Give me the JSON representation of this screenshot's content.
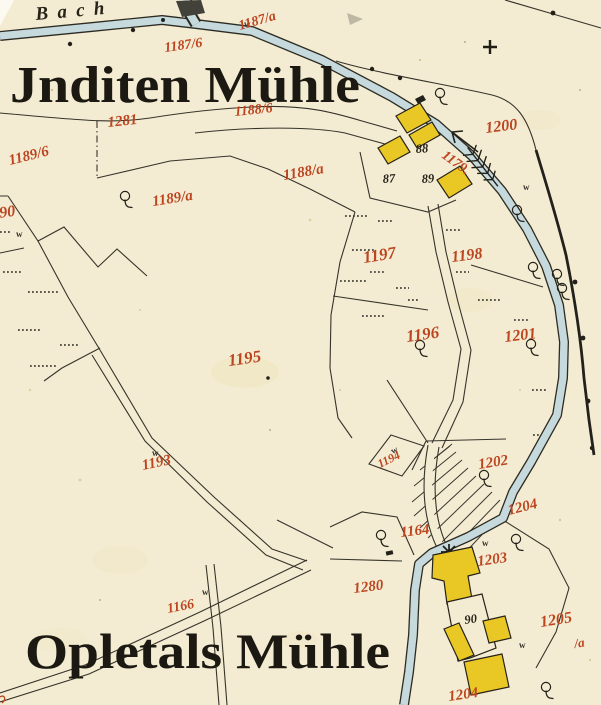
{
  "map": {
    "stream_label": "Bach",
    "mill_top": "Jnditen Mühle",
    "mill_bottom": "Opletals Mühle"
  },
  "colors": {
    "paper": "#f4ecd2",
    "ink": "#2b2920",
    "parcel_red": "#bc4520",
    "water": "#c6d9dd",
    "building_yellow": "#e9c826"
  },
  "symbols": {
    "meadow": "w"
  },
  "parcel_numbers": {
    "p1187a": "1187/a",
    "p1187b": "1187/6",
    "p1188b": "1188/6",
    "p1281": "1281",
    "p1189b": "1189/6",
    "p1188a": "1188/a",
    "p1189a": "1189/a",
    "p1190": "1190",
    "p1200": "1200",
    "p1179": "1179.",
    "p1197": "1197",
    "p1198": "1198",
    "p1196": "1196",
    "p1201": "1201",
    "p1195": "1195",
    "p1193": "1193",
    "p1194": "1194",
    "p1202": "1202",
    "p1204_upper": "1204",
    "p1164": "1164",
    "p1203": "1203",
    "p1280": "1280",
    "p1166": "1166",
    "p1205": "1205",
    "p1205_suffix": "/a",
    "p1204_lower": "1204"
  },
  "house_numbers": {
    "h87": "87",
    "h88": "88",
    "h89": "89",
    "h90": "90"
  }
}
